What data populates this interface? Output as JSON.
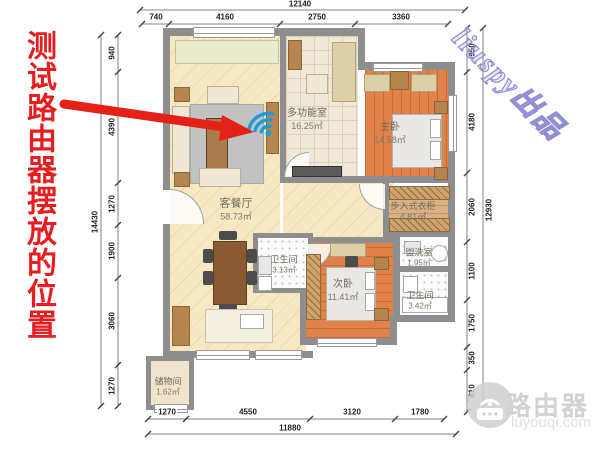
{
  "annotation": {
    "text": "测试路由器摆放的位置"
  },
  "watermarks": {
    "diagonal": "liuspy出品",
    "brand": "路由器",
    "site": "luyouqi.com"
  },
  "plan": {
    "rooms": [
      {
        "name": "客餐厅",
        "area": "58.73㎡"
      },
      {
        "name": "多功能室",
        "area": "16.25㎡"
      },
      {
        "name": "主卧",
        "area": "14.58㎡"
      },
      {
        "name": "步入式衣柜",
        "area": "4.81㎡"
      },
      {
        "name": "次卧",
        "area": "11.41㎡"
      },
      {
        "name": "卫生间",
        "area": "3.13㎡"
      },
      {
        "name": "盥洗室",
        "area": "1.95㎡"
      },
      {
        "name": "卫生间",
        "area": "3.42㎡"
      },
      {
        "name": "储物间",
        "area": "1.62㎡"
      }
    ],
    "dimensions": {
      "top": {
        "total": "12140",
        "segments": [
          "740",
          "4160",
          "2750",
          "3360"
        ]
      },
      "bottom": {
        "total": "11880",
        "segments": [
          "1270",
          "4550",
          "3120",
          "1780"
        ]
      },
      "left": {
        "total": "14430",
        "segments": [
          "940",
          "4390",
          "1270",
          "1900",
          "3060",
          "1270"
        ]
      },
      "right": {
        "total": "12930",
        "segments": [
          "950",
          "4180",
          "2060",
          "1100",
          "1750",
          "350",
          "810"
        ]
      }
    }
  },
  "colors": {
    "annotation_red": "#e81d20",
    "wifi_blue": "#1b9cd9"
  }
}
